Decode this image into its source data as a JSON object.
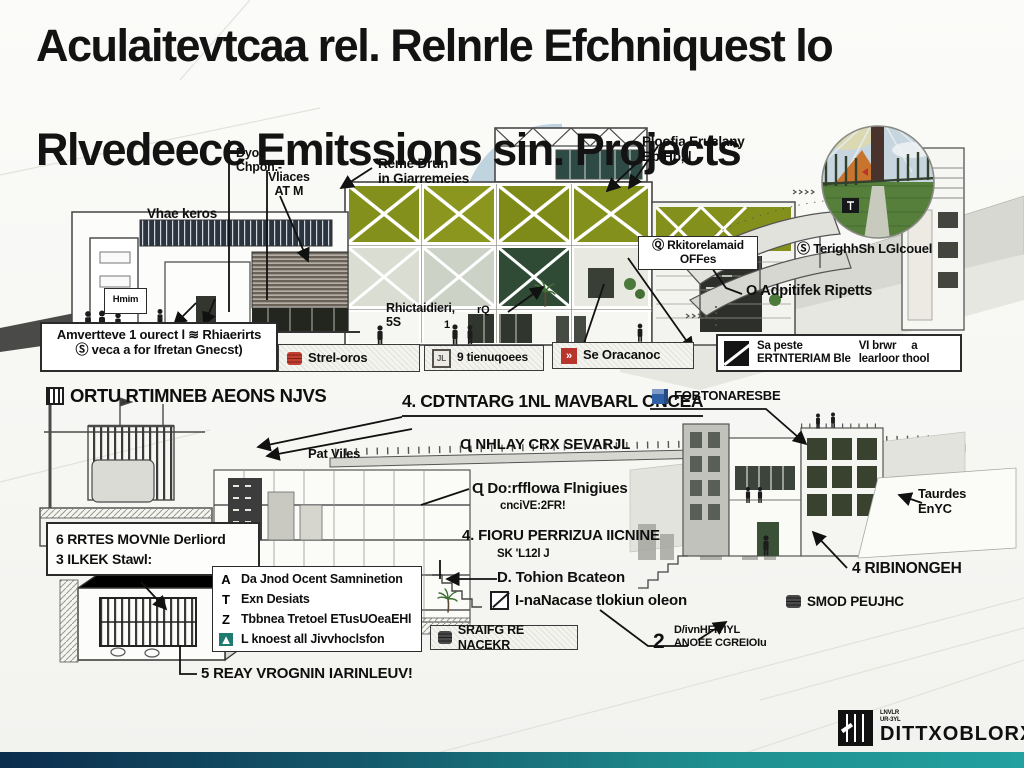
{
  "colors": {
    "olive": "#84901c",
    "dark_glass": "#2f4a35",
    "accent_red": "#b8352c",
    "accent_blue": "#2f5fa5",
    "accent_teal": "#1f7a6f",
    "footer_left": "#0c2d4d",
    "footer_right": "#23a0a0"
  },
  "icons": {
    "wave": "≋",
    "chev": "»",
    "tri": "▲",
    "stamp": "JL"
  },
  "title": {
    "line1": "Aculaitevtcaa rel. Relnrle Efchniquest lo",
    "line2": "Rlvedeece Emitssions sin. Projects"
  },
  "top": {
    "dyoc": "Dyoc\nChpon.-",
    "vliaces": "Vliaces\nAT M",
    "vhae": "Vhae keros",
    "reme": "Reme Drun\nin Giarremeies",
    "ploofia": "Ploofia Eruclany\nBbiHb, |",
    "hmim": "Hmim",
    "rhict": "Rhictaidieri,\n5S",
    "rq": "rQ",
    "one": "1",
    "rkito": "Ⓠ Rkitorelamaid\nOFFes",
    "adpitifek": "O Adpitifek Ripetts",
    "terighhsh": "Ⓢ TerighhSh LGlcouel",
    "legend_left_row1": "Amvertteve 1 ourect l  ≋ Rhiaerirts",
    "legend_left_row2": "Ⓢ veca a for Ifretan Gnecst)",
    "strip": [
      {
        "label": "Strel-oros"
      },
      {
        "label": "9 tienuqoees"
      },
      {
        "label": "Se Oracanoc"
      }
    ],
    "legend_right_col1": "Sa peste\nERTNTERIAM Ble",
    "legend_right_col2": "VI brwr     a\nlearloor thool"
  },
  "mid": {
    "ortu": "ORTU RTIMNEB AEONS NJVS",
    "cdtn": "4. CDTNTARG 1NL MAVBARL ONCEA",
    "fobto": "FOBTONARESBE",
    "pat": "Pat Viles",
    "nhlay": "Ɋ NHLAY CRX SEVARJL",
    "doflowa": "Ɋ Do:rfflowa Flnigiues",
    "doflowa_sub": "cnciVE:2FR!",
    "fioru": "4. FIORU PERRIZUA IICNINE",
    "fioru_sub": "SK 'L12l J",
    "rrtes": "6 RRTES MOVNIe Derliord\n3 ILKEK Stawl:"
  },
  "bottom": {
    "checklist": [
      {
        "glyph": "A",
        "text": "Da Jnod Ocent Samninetion"
      },
      {
        "glyph": "T",
        "text": "Exn Desiats"
      },
      {
        "glyph": "Z",
        "text": "Tbbnea Tretoel ETusUOeaEHl"
      },
      {
        "glyph": "▲",
        "text": "L knoest all Jivvhoclsfon"
      }
    ],
    "reay": "5 REAY VROGNIN IARINLEUV!",
    "tohion": "D. Tohion Bcateon",
    "inanacase": "I-naNacase tlokiun oleon",
    "sraifg": "SRAIFG RE NACEKR",
    "num2": "2",
    "dvn": "D/ivnHFITIYL\nANOEE CGREIOIu",
    "taurdes": "Taurdes\nEnYC",
    "ribinongeh": "4 RIBINONGEH",
    "smod": "SMOD PEUJHC"
  },
  "footer": {
    "logo": "DITTXOBLORX",
    "logo_small": "LNVLR\nUR-3YL"
  }
}
